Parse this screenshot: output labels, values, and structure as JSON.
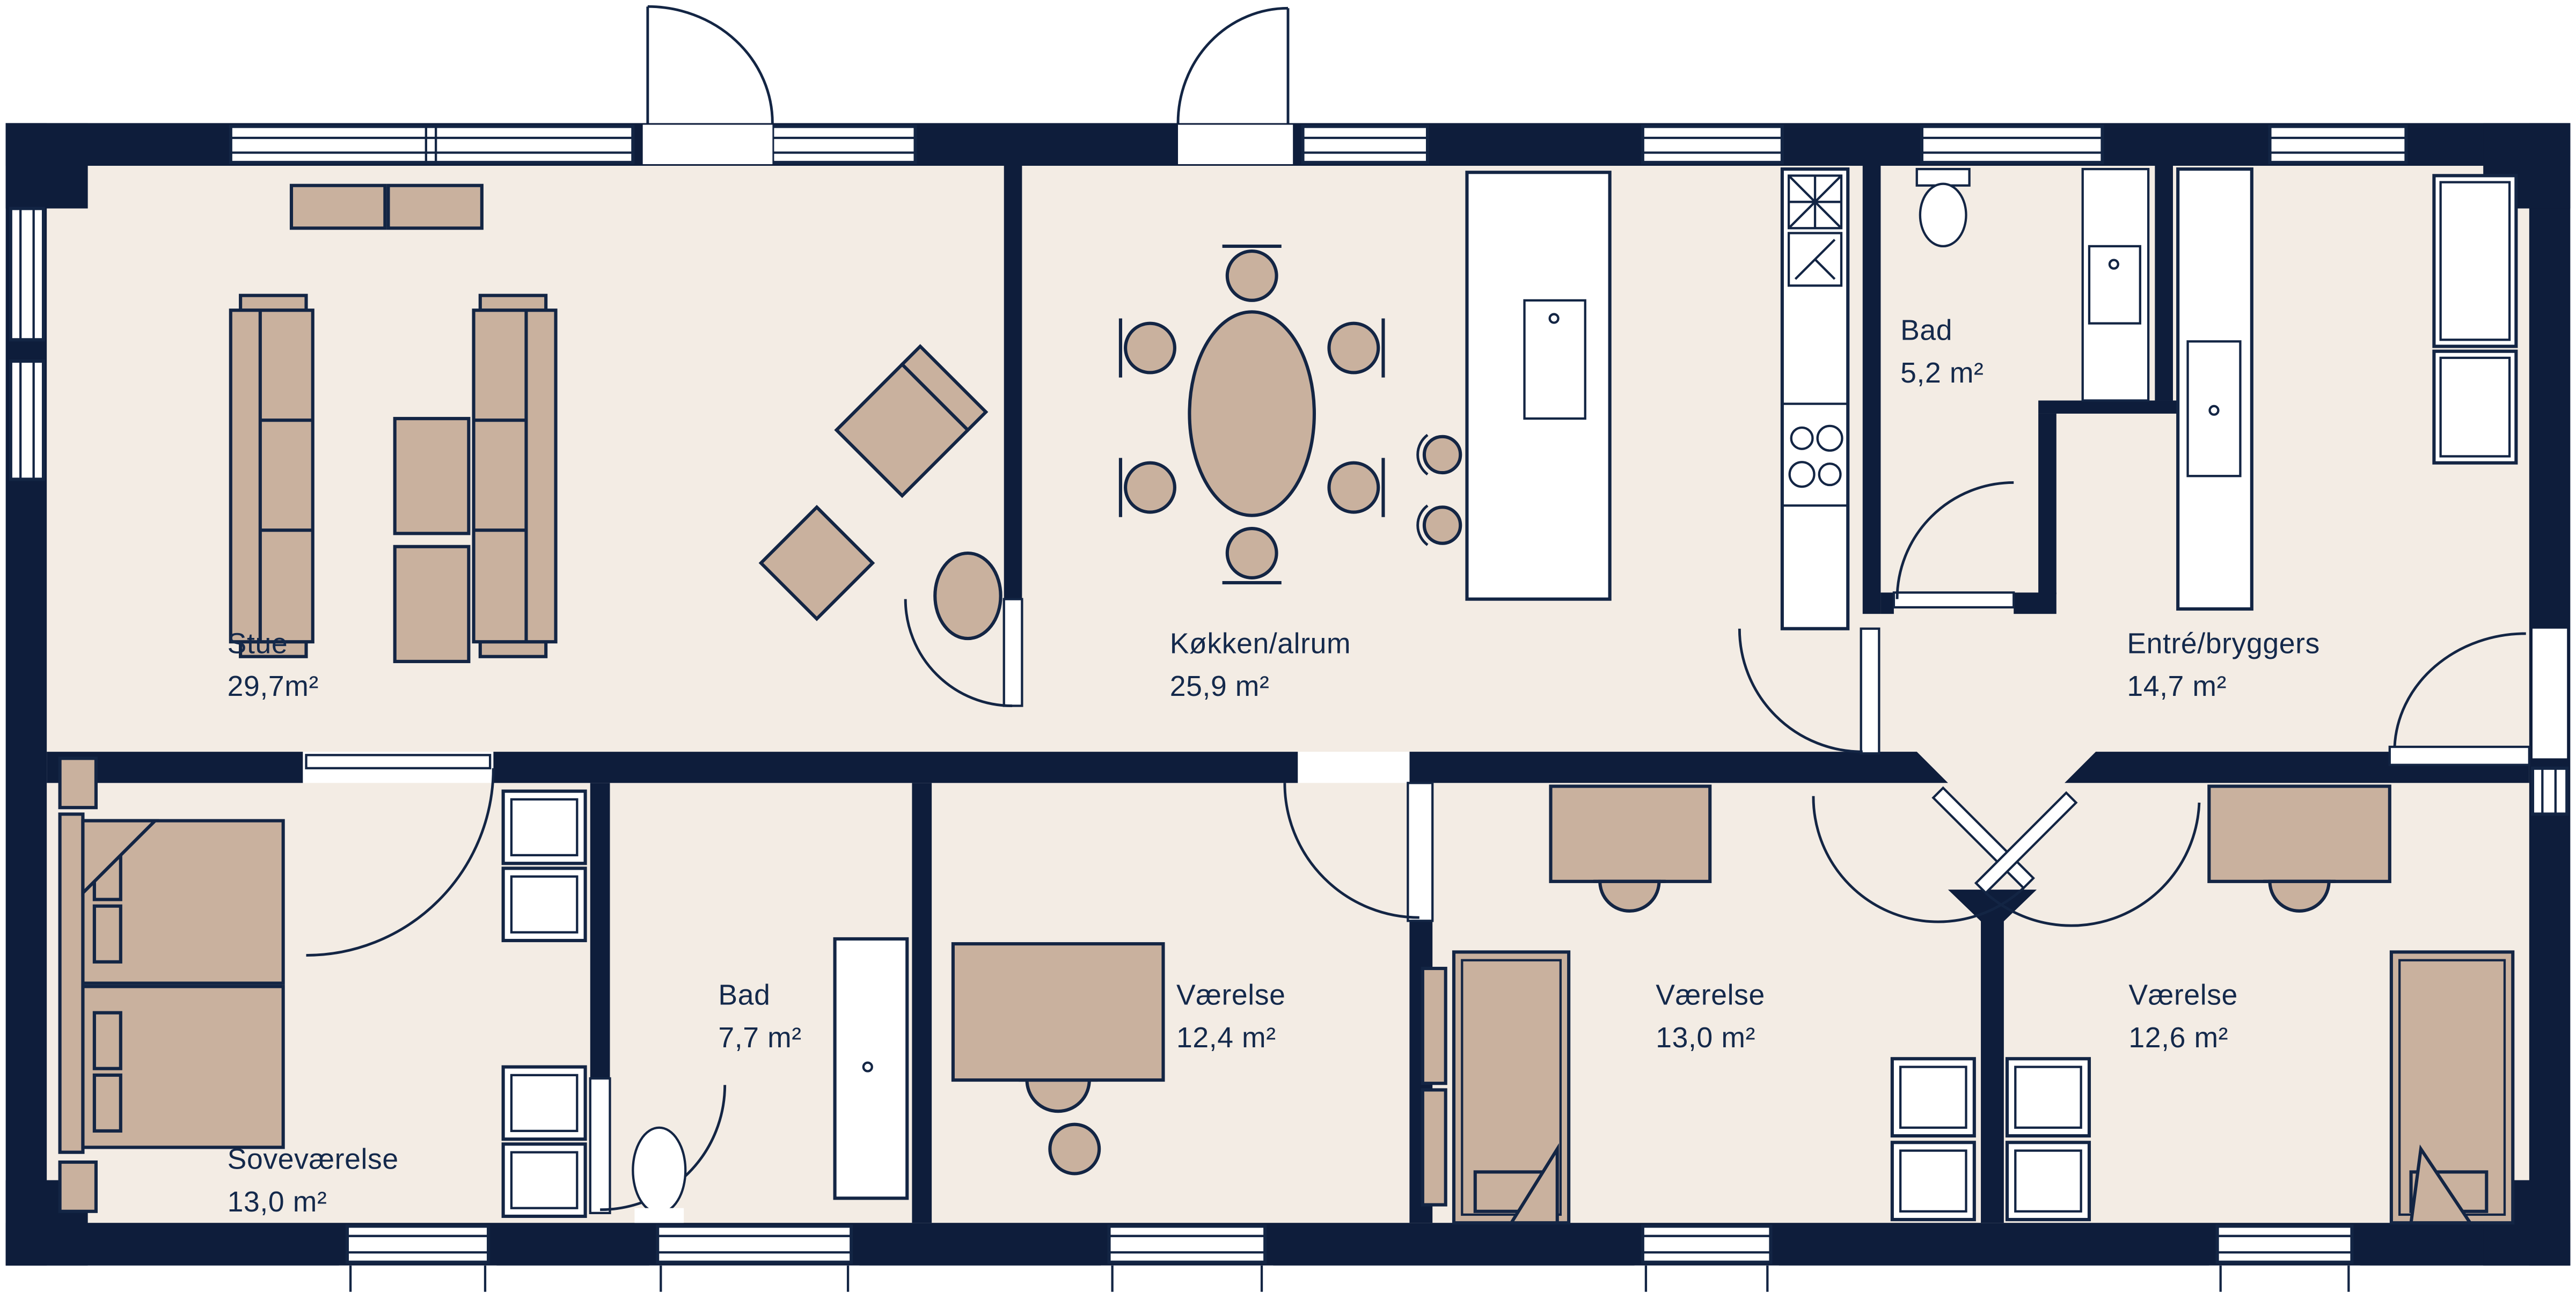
{
  "title": "Floor plan",
  "colors": {
    "wall": "#0e1d3b",
    "floor": "#f3ece4",
    "furn": "#c9b19e",
    "line": "#132544",
    "label": "#14294b",
    "white": "#ffffff"
  },
  "rooms": [
    {
      "id": "stue",
      "name": "Stue",
      "area": "29,7m²"
    },
    {
      "id": "kokken",
      "name": "Køkken/alrum",
      "area": "25,9 m²"
    },
    {
      "id": "bad-top",
      "name": "Bad",
      "area": "5,2 m²"
    },
    {
      "id": "entre",
      "name": "Entré/bryggers",
      "area": "14,7 m²"
    },
    {
      "id": "sovevaerelse",
      "name": "Soveværelse",
      "area": "13,0 m²"
    },
    {
      "id": "bad-bottom",
      "name": "Bad",
      "area": "7,7 m²"
    },
    {
      "id": "vaerelse-1",
      "name": "Værelse",
      "area": "12,4 m²"
    },
    {
      "id": "vaerelse-2",
      "name": "Værelse",
      "area": "13,0 m²"
    },
    {
      "id": "vaerelse-3",
      "name": "Værelse",
      "area": "12,6 m²"
    }
  ]
}
